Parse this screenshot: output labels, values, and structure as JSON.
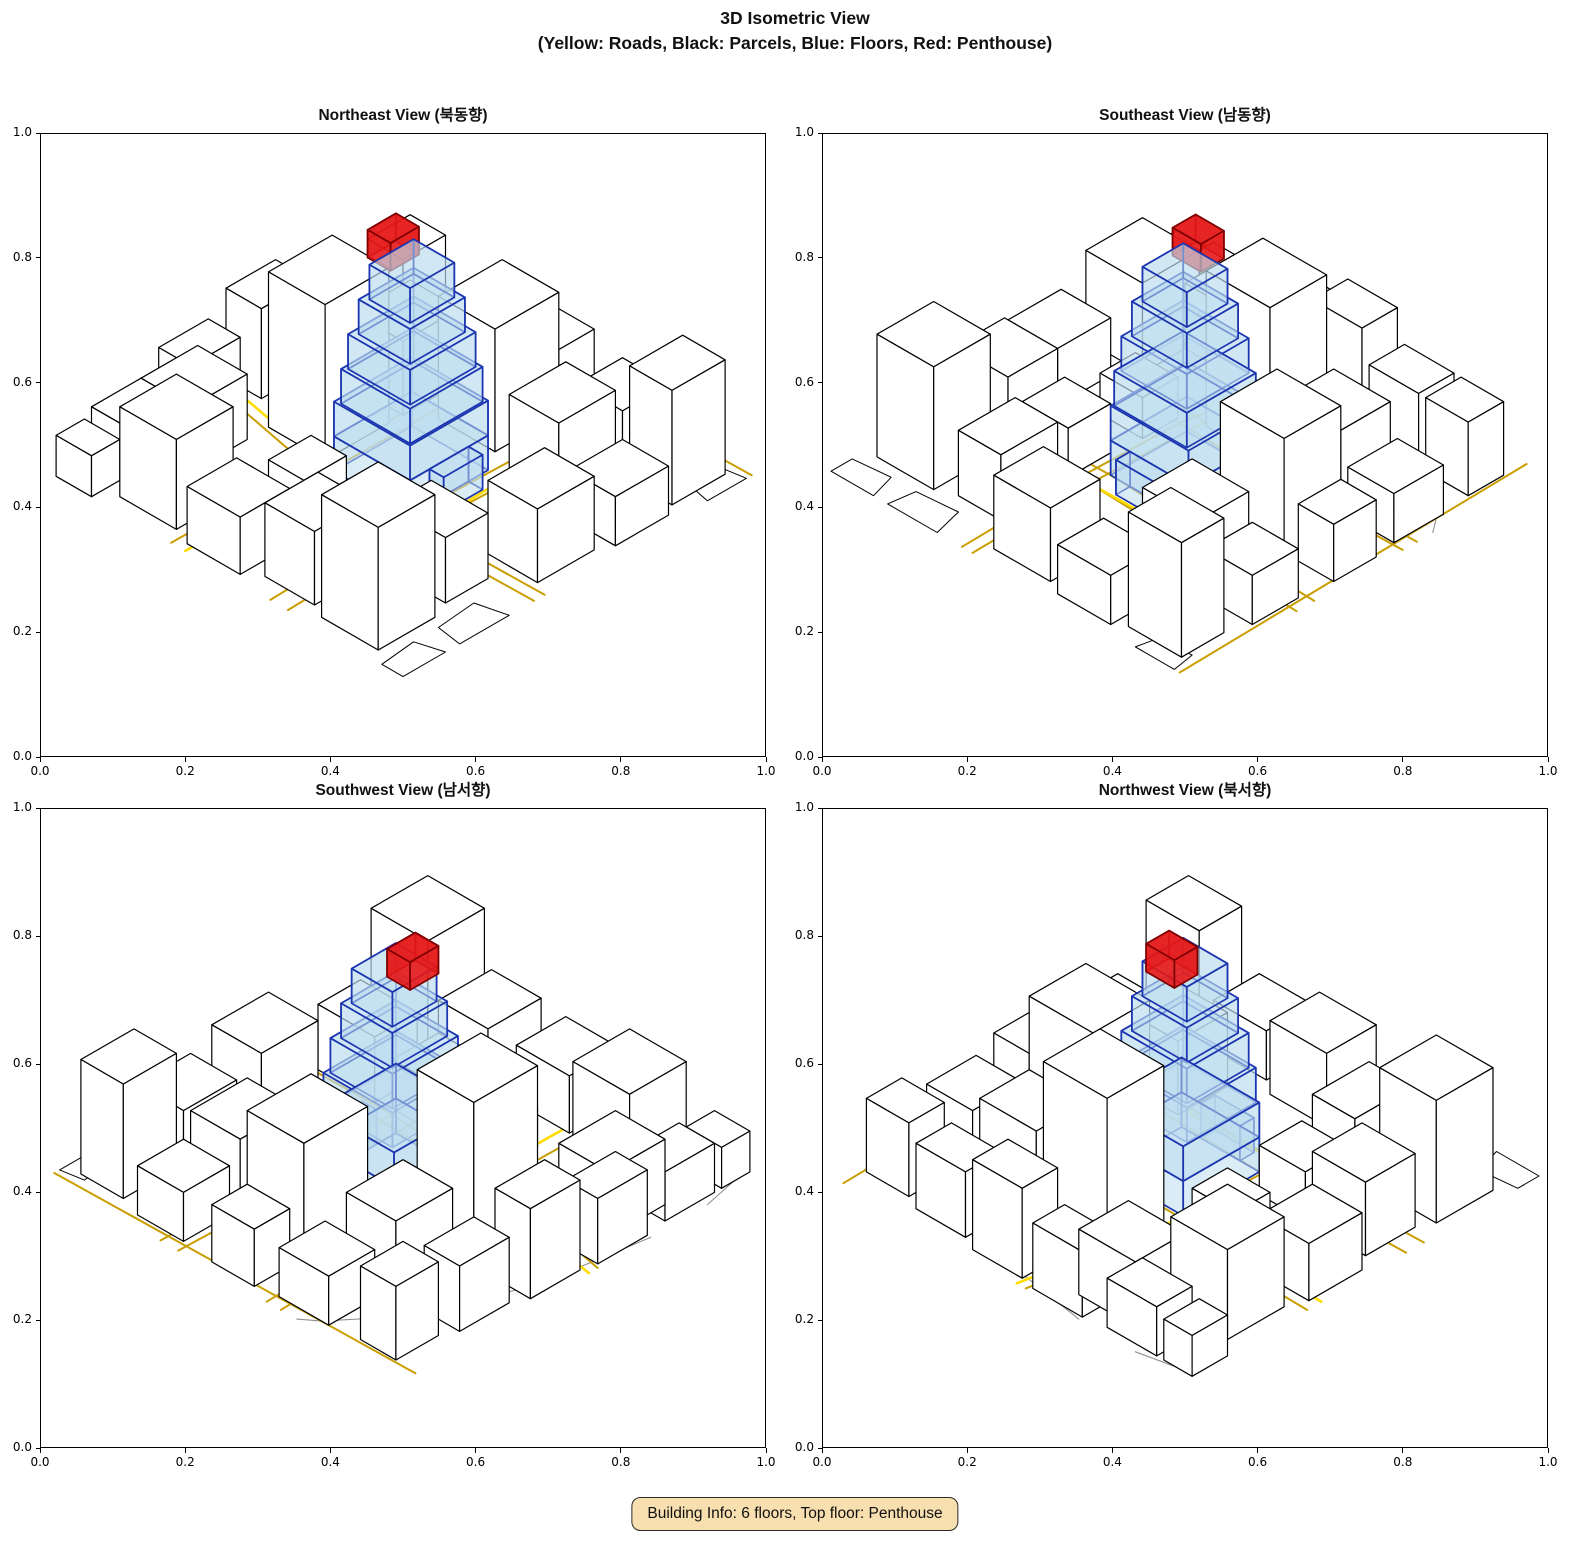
{
  "figure": {
    "title_line1": "3D Isometric View",
    "title_line2": "(Yellow: Roads, Black: Parcels, Blue: Floors, Red: Penthouse)"
  },
  "subplots": [
    {
      "id": "northeast",
      "title": "Northeast View (북동향)",
      "rotation_deg": 0
    },
    {
      "id": "southeast",
      "title": "Southeast View (남동향)",
      "rotation_deg": 270
    },
    {
      "id": "southwest",
      "title": "Southwest View (남서향)",
      "rotation_deg": 180
    },
    {
      "id": "northwest",
      "title": "Northwest View (북서향)",
      "rotation_deg": 90
    }
  ],
  "axis": {
    "x_ticks": [
      "0.0",
      "0.2",
      "0.4",
      "0.6",
      "0.8",
      "1.0"
    ],
    "y_ticks": [
      "0.0",
      "0.2",
      "0.4",
      "0.6",
      "0.8",
      "1.0"
    ]
  },
  "badge": {
    "text": "Building Info: 6 floors, Top floor: Penthouse",
    "background": "#F8DFB0",
    "border": "#2a2a2a"
  },
  "colors": {
    "background": "#ffffff",
    "parcel_edge": "#000000",
    "building_fill": "#ffffff",
    "road": "#C99E00",
    "road_bright": "#FFDD00",
    "boundary_gray": "#909090",
    "floor_fill": "#BBDCEE",
    "floor_fill_opacity": 0.55,
    "floor_edge": "#1C35B0",
    "penthouse_fill": "#E51717",
    "penthouse_fill_opacity": 0.9,
    "penthouse_edge": "#7F0000"
  },
  "scene": {
    "buildings_xyxyh": [
      [
        0.03,
        0.1,
        0.19,
        0.26,
        0.3
      ],
      [
        0.05,
        0.3,
        0.2,
        0.44,
        0.18
      ],
      [
        0.02,
        0.48,
        0.16,
        0.63,
        0.14
      ],
      [
        0.04,
        0.68,
        0.2,
        0.84,
        0.22
      ],
      [
        0.2,
        0.8,
        0.36,
        0.94,
        0.16
      ],
      [
        0.24,
        0.12,
        0.36,
        0.28,
        0.16
      ],
      [
        0.22,
        0.32,
        0.35,
        0.44,
        0.12
      ],
      [
        0.42,
        0.04,
        0.58,
        0.18,
        0.18
      ],
      [
        0.62,
        0.02,
        0.77,
        0.15,
        0.12
      ],
      [
        0.8,
        0.04,
        0.95,
        0.16,
        0.28
      ],
      [
        0.66,
        0.22,
        0.82,
        0.36,
        0.18
      ],
      [
        0.84,
        0.22,
        0.97,
        0.35,
        0.12
      ],
      [
        0.68,
        0.42,
        0.86,
        0.58,
        0.3
      ],
      [
        0.88,
        0.44,
        0.98,
        0.56,
        0.14
      ],
      [
        0.42,
        0.64,
        0.6,
        0.8,
        0.38
      ],
      [
        0.64,
        0.64,
        0.8,
        0.78,
        0.18
      ],
      [
        0.84,
        0.62,
        0.97,
        0.76,
        0.12
      ],
      [
        0.1,
        0.88,
        0.24,
        0.98,
        0.12
      ],
      [
        0.3,
        0.9,
        0.44,
        0.99,
        0.16
      ],
      [
        0.48,
        0.88,
        0.62,
        0.98,
        0.22
      ],
      [
        0.66,
        0.86,
        0.8,
        0.96,
        0.16
      ],
      [
        0.84,
        0.84,
        0.96,
        0.94,
        0.18
      ],
      [
        0.24,
        0.52,
        0.36,
        0.62,
        0.1
      ],
      [
        0.0,
        0.88,
        0.08,
        0.98,
        0.1
      ]
    ],
    "roads": [
      {
        "pts": [
          [
            0.37,
            0.0
          ],
          [
            0.365,
            0.3
          ],
          [
            0.375,
            0.62
          ],
          [
            0.45,
            1.0
          ]
        ],
        "bright": false
      },
      {
        "pts": [
          [
            0.4,
            0.0
          ],
          [
            0.395,
            0.3
          ],
          [
            0.405,
            0.62
          ],
          [
            0.475,
            1.0
          ]
        ],
        "bright": false
      },
      {
        "pts": [
          [
            0.0,
            0.325
          ],
          [
            0.4,
            0.335
          ],
          [
            1.0,
            0.315
          ]
        ],
        "bright": false
      },
      {
        "pts": [
          [
            0.0,
            0.375
          ],
          [
            0.4,
            0.385
          ],
          [
            1.0,
            0.365
          ]
        ],
        "bright": false
      },
      {
        "pts": [
          [
            0.0,
            0.615
          ],
          [
            0.62,
            0.605
          ],
          [
            1.0,
            0.615
          ]
        ],
        "bright": false
      },
      {
        "pts": [
          [
            0.0,
            0.655
          ],
          [
            0.62,
            0.645
          ],
          [
            1.0,
            0.655
          ]
        ],
        "bright": false
      },
      {
        "pts": [
          [
            0.985,
            0.0
          ],
          [
            0.965,
            1.0
          ]
        ],
        "bright": false
      },
      {
        "pts": [
          [
            0.4,
            0.335
          ],
          [
            0.62,
            0.34
          ],
          [
            0.8,
            0.33
          ]
        ],
        "bright": true
      },
      {
        "pts": [
          [
            0.405,
            0.62
          ],
          [
            0.475,
            1.0
          ]
        ],
        "bright": true
      },
      {
        "pts": [
          [
            0.0,
            0.615
          ],
          [
            0.3,
            0.61
          ]
        ],
        "bright": true
      }
    ],
    "gray_boundaries": [
      [
        [
          0.3,
          1.0
        ],
        [
          0.55,
          0.96
        ],
        [
          0.8,
          0.88
        ],
        [
          0.97,
          0.74
        ],
        [
          1.0,
          0.7
        ]
      ],
      [
        [
          0.0,
          0.97
        ],
        [
          0.14,
          1.0
        ]
      ]
    ],
    "ground_parcels": [
      [
        [
          0.0,
          0.0
        ],
        [
          0.12,
          0.0
        ],
        [
          0.1,
          0.07
        ],
        [
          0.0,
          0.06
        ]
      ],
      [
        [
          0.86,
          0.0
        ],
        [
          0.97,
          0.0
        ],
        [
          0.96,
          0.06
        ],
        [
          0.87,
          0.05
        ]
      ],
      [
        [
          0.16,
          0.0
        ],
        [
          0.3,
          0.0
        ],
        [
          0.28,
          0.08
        ],
        [
          0.17,
          0.07
        ]
      ]
    ],
    "target_building": {
      "floors_xyxyzz": [
        [
          0.46,
          0.345,
          0.57,
          0.385,
          0.0,
          0.085
        ],
        [
          0.405,
          0.385,
          0.625,
          0.6,
          0.0,
          0.085
        ],
        [
          0.405,
          0.385,
          0.625,
          0.6,
          0.085,
          0.17
        ],
        [
          0.41,
          0.39,
          0.615,
          0.585,
          0.17,
          0.255
        ],
        [
          0.42,
          0.4,
          0.605,
          0.575,
          0.255,
          0.34
        ],
        [
          0.435,
          0.415,
          0.59,
          0.56,
          0.34,
          0.425
        ],
        [
          0.45,
          0.43,
          0.575,
          0.545,
          0.425,
          0.51
        ]
      ],
      "penthouse_xyxyzz": [
        0.465,
        0.5,
        0.545,
        0.565,
        0.51,
        0.578
      ]
    }
  }
}
